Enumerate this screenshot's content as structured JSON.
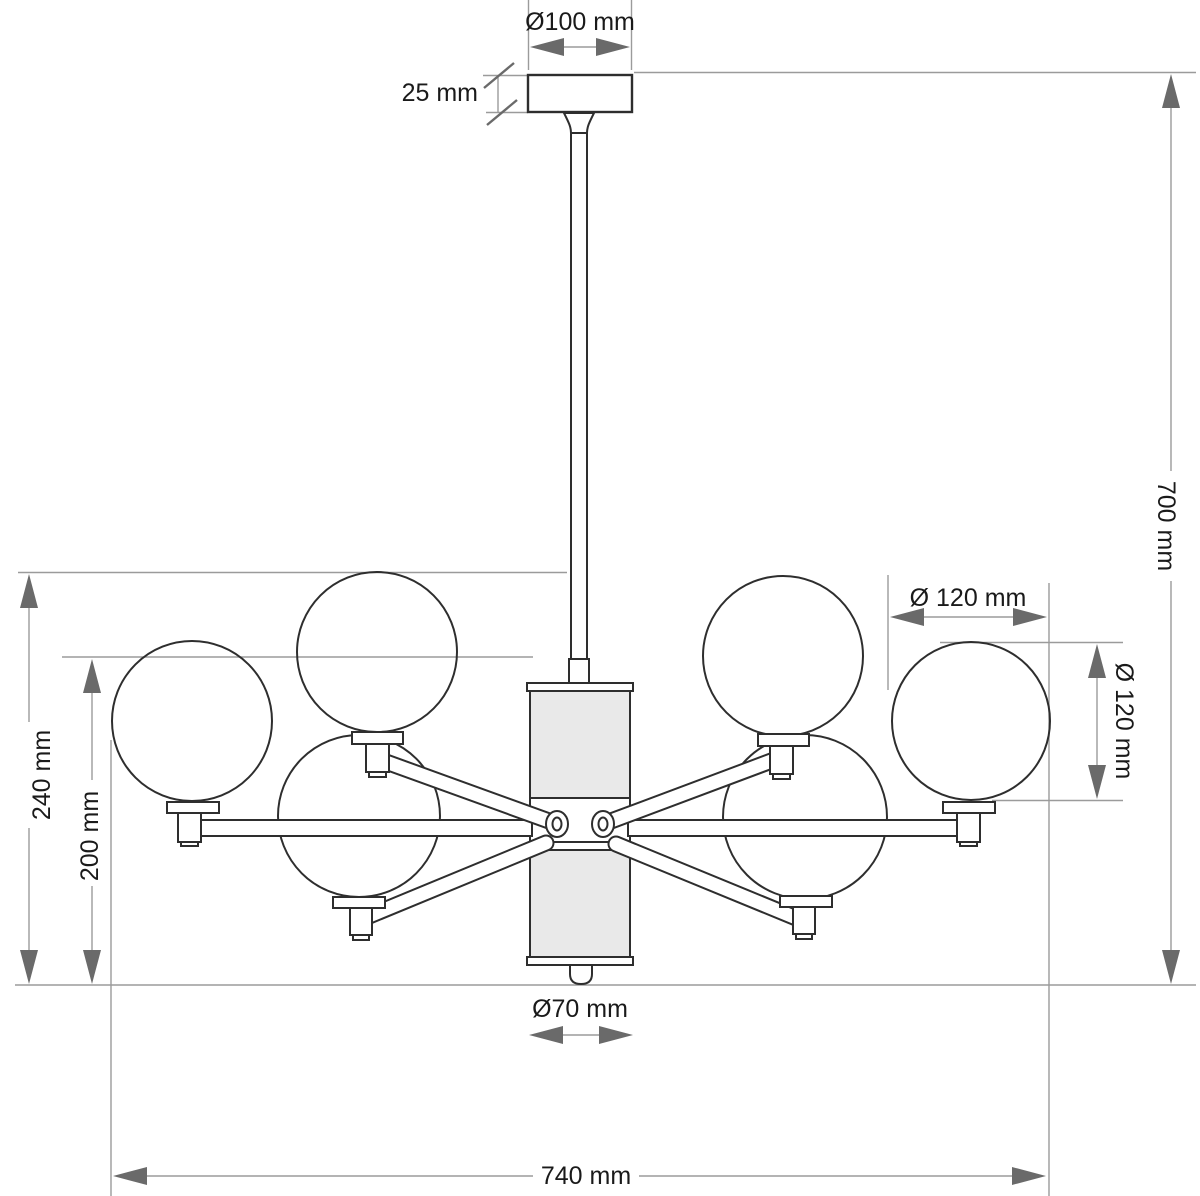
{
  "drawing": {
    "kind": "chandelier dimension drawing",
    "globe_count": 6
  },
  "labels": {
    "canopy_diameter": "Ø100 mm",
    "canopy_height": "25 mm",
    "overall_height": "700 mm",
    "globe_diameter_width": "Ø 120 mm",
    "globe_diameter_height": "Ø 120 mm",
    "upper_globes_height": "240 mm",
    "lower_globes_height": "200 mm",
    "bottom_diameter": "Ø70 mm",
    "overall_width": "740 mm"
  },
  "colors": {
    "outline": "#2e2e2e",
    "dimension_line": "#9b9b9b",
    "arrowhead": "#6a6a6a",
    "label_text": "#1a1a1a",
    "column_fill": "#e9e9e9",
    "background": "#ffffff"
  }
}
